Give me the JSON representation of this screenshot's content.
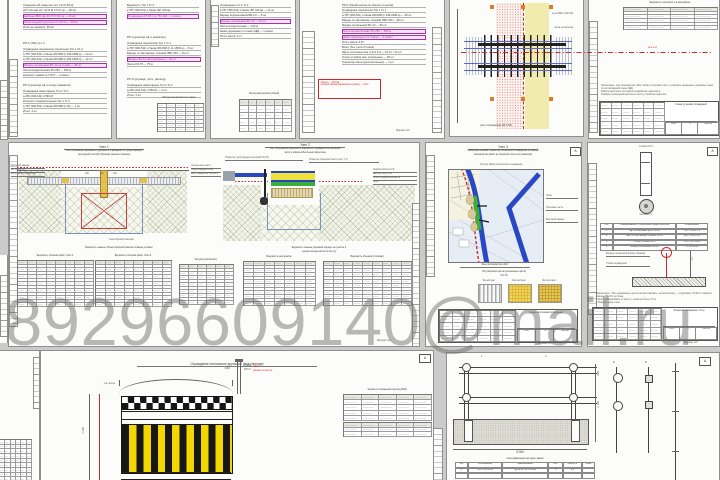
{
  "watermark": "89296609140@mail.ru",
  "colors": {
    "canvas": "#cbcbcb",
    "sheet": "#fcfcfa",
    "red": "#cc2a2a",
    "magenta": "#a832a8",
    "blue": "#2a48c4",
    "green": "#3cae3c",
    "stripe_yellow": "#f2d800",
    "pale_yellow": "#f1ecae",
    "orange": "#e07b28"
  },
  "stamp": {
    "sheet_label": "Лист",
    "sheets_label": "Листов"
  },
  "top": {
    "s1": {
      "b1": [
        {
          "t": "Уширение а/б покрытия тип 1 (h=0,56 м)"
        },
        {
          "t": "а/б плотный м/з тип Б М II h=5 см — 96 м2"
        },
        {
          "t": "Щебень М800 фр.40-70 h=30 см — 29 м3",
          "hl": true
        },
        {
          "t": "Песок средней крупности h=20 см — 19 м3",
          "hl": true
        },
        {
          "t": "Итого на захватку: 96 м2"
        }
      ],
      "h1": "РР-1 (УШ-1) п.1",
      "b2": [
        {
          "t": "Ограждение переносное сигнальное Тип 1 С1-3"
        },
        {
          "t": "а-787 (306-541) и башм.180-808 (п.349-1808-а) — 24 шт"
        },
        {
          "t": "а-787 (306-541) и башм.180-808 (п.363-1818-б) — 12 шт"
        },
        {
          "t": "Фонарь сигнальный ФС-12 на стойке — 36 шт",
          "hl": true
        },
        {
          "t": "Лента оградительная ЛО-250 — 250 м"
        },
        {
          "t": "Комплект знаков по ГОСТ — 2 компл"
        }
      ],
      "h2": "РР-2 (расход на 1 опору захватки)",
      "b3": [
        {
          "t": "Ограждение инвентарное Тип 2 Тс-1"
        },
        {
          "t": "а-250 (248-441) и 560-М"
        },
        {
          "t": "Комплект соединительный Тип 1 Тс-У"
        },
        {
          "t": "а-787 (306-541) и башм.180-808 (п.16) — 4 шт"
        },
        {
          "t": "Итого: 4 шт"
        }
      ]
    },
    "s2": {
      "b1": [
        {
          "t": "Ведомость Тип 1 Тс 3"
        },
        {
          "t": "в 787 (306-541) и башм.-БР 340 вв"
        },
        {
          "t": "Ограждение 97-ЛК 2 м; ПС-340 — 1 компл",
          "hl": true
        }
      ],
      "h1": "РР-4 (расход на 1 захватку)",
      "b2": [
        {
          "t": "Ограждение переносное Тип 1 Тс 1"
        },
        {
          "t": "а-787 (306-541) и башм.180-808 (п.11-1808-а) — 8 шт"
        },
        {
          "t": "Барьер со световозвр. пленкой ЛВО 250 — 16 шт"
        },
        {
          "t": "Фонарь ФС-12 светодиодный — 16 шт",
          "hl": true
        },
        {
          "t": "Лента ЛО-75 — 75 м"
        }
      ],
      "h2": "РР-5 (огражд. пути, расход)",
      "b3": [
        {
          "t": "Ограждение инвентарное Тип 2 Тс 2"
        },
        {
          "t": "а-250 (244-141) и 560-М — 2 шт"
        },
        {
          "t": "Итого: 2 шт"
        }
      ],
      "tcap": "Расход материалов на 1 звено"
    },
    "s3": {
      "b1": [
        {
          "t": "Ограждение тип 1 Тс 2"
        },
        {
          "t": "в 787 (306-541) и башм.-БР 340 вв — 12 шт"
        },
        {
          "t": "Барьер водоналивной БВ-2,0 — 8 шт"
        },
        {
          "t": "Фонарь сигнальный ФС-12 — 24 шт",
          "hl": true
        },
        {
          "t": "Лента оградительная — 120 м"
        },
        {
          "t": "Знаки дорожные по схеме ОДД — 1 компл"
        },
        {
          "t": "Итого масса: 2,4 т"
        }
      ],
      "scap": "Расход материалов (общий)"
    },
    "s4": {
      "b1": [
        {
          "t": "РР-6 (общий расход по объекту в целом)"
        },
        {
          "t": "Ограждение переносное Тип 1 Тс 1"
        },
        {
          "t": "а-787 (306-541) и башм.180-808 (п.349-1808-а) — 48 шт"
        },
        {
          "t": "Барьер со световозвр. пленкой ЛВО 250 — 96 шт"
        },
        {
          "t": "Фонарь сигнальный ФС-12 — 96 шт"
        },
        {
          "t": "Лента оградительная ЛО-250 — 500 м",
          "hl": true
        },
        {
          "t": "Знаки дорожные (I-IV этапы) — 1 компл",
          "hl": true
        },
        {
          "t": "Итого масса: 4,8 т"
        }
      ],
      "b2": [
        {
          "t": "Всего (без учета III этапа):"
        },
        {
          "t": "Щиты сплошные инв. 2,0х1,6 м — 24 шт / 12 шт"
        },
        {
          "t": "Опоры (стойки) инв. сигнальные — 48 шт"
        },
        {
          "t": "Генератор света (дополнительно) — 1 шт"
        }
      ],
      "note": [
        "1 Всего — 547 м2",
        "2 Длина забора (временное огражд.) — 62 м"
      ],
      "fmt": "Формат А3"
    },
    "s5": {
      "lbl1": "сетка 5Вр1 100х100",
      "lbl2": "лента сигнальная",
      "cap": "узел сопряжения (М 1:50)",
      "axis": "ось 2-2"
    },
    "s6": {
      "tcap": "Ведомость потребности в материалах",
      "par": [
        "Примечание: при производстве работ вблизи проезжей части установить временные дорожные знаки по согласованной схеме ОДД.",
        "Работы выполнять при закрытом движении транспорта.",
        "Разборку ограждения выполнять после устройства покрытия."
      ],
      "st": {
        "name": "Схема установки ограждений",
        "num": "3"
      },
      "fmt": "Формат А3"
    }
  },
  "mid": {
    "m1": {
      "u1t1": "Узел 1",
      "u1t2": "Узел сопряжения временного дорожного ограждения со существующей",
      "u1t3": "тротуарной плиткой (обратная засыпка траншеи)",
      "u1ll": [
        "Бортовой камень",
        "БР 100.30.15",
        "Восстановл. покрытия"
      ],
      "u1lr": [
        "Сигнальная лента",
        "Подстилающий слой",
        "Борт. камень БР 100.20.8"
      ],
      "u1dims": [
        "150",
        "60",
        "150"
      ],
      "u1x": "зона обратной засыпки",
      "u1cap": "Ведомость замены (объем обратной засыпки показан условно)",
      "u2t1": "Узел 2",
      "u2t2": "Узел сопряжения временного дорожного ограждения на проезжей",
      "u2t3": "части с асфальтобетонным покрытием",
      "u2ul1": "Покрытие (тротуарная плитка) ЕР 30,9 Б",
      "u2ul2": "Покрытие проезжей части (лист 7.1)",
      "u2lr": [
        "Асфальтобетон h=5",
        "Щебень фр.20-40",
        "Песок средней крупности",
        "Грунт"
      ],
      "u2cap1": "Ведомость замены дорожной одежды на участке 2",
      "u2cap2": "(длина определяется по месту)",
      "tcaps": [
        "Ведомость объемов работ. Этап 1",
        "Ведомость объемов работ. Этап 2",
        "Ресурсы (вспомогат.)",
        "Ведомость материалов",
        "Ведомость объемов (итоговая)"
      ],
      "fmt": "Формат А3"
    },
    "m2": {
      "t1": "Узел 3",
      "t2": "Схема расстановки элементов сигнального ограждения и границы",
      "t3": "производства работ на проезжей части (по захваткам)",
      "mtop": "Тротуар      Линия сигнального ограждения",
      "mlr": [
        "Газон",
        "Проезжая часть",
        "Бортовой камень"
      ],
      "mapcap": "Зона производства работ",
      "swcap1": "Тип раскраски щитов (сигнальные цвета)",
      "swcap2": "М 1:20",
      "swl": [
        "Белый цвет",
        "Желтый цвет",
        "Желтый цвет"
      ],
      "st": {
        "name": "Схема расстановки ограждения",
        "num": "4"
      },
      "corner": "А",
      "fmt": "Формат А3"
    },
    "m3": {
      "postcap": "Стойка СО-1",
      "circcap": "Сечение 1-1",
      "tcols": [
        "Поз.",
        "Наименование и техническая характеристика",
        "Обозначение"
      ],
      "rows": [
        [
          "1",
          "Щит сигнальный ЩС 2,0х1,6",
          "ГОСТ 23407-78"
        ],
        [
          "2",
          "Щит со световозвр. пленкой тип А",
          "сер. 3.503.1-66"
        ],
        [
          "3",
          "Опора (стойка) СО-1",
          "ГОСТ 10704-91"
        ],
        [
          "4",
          "Фонарь сигнальный ФС-12",
          "ТУ 3461-001"
        ]
      ],
      "hookl1": "Фонарь сигнальный (опорн. башмак)",
      "hookl2": "Стойка ограждения",
      "hookdim": "750",
      "note": [
        "Примечание: 1 Все деревянные детали антисептировать, металлические — огрунтовать ГФ-021 и окрасить эмалью ПФ-115 за 2 раза.",
        "2 Щиты устанавливать по месту с шагом не более 1,5 м.",
        "3 Размеры даны в мм."
      ],
      "st": {
        "name": "Элементы ограждения. Узлы",
        "num": "5"
      },
      "corner": "А",
      "fmt": "Формат А3"
    }
  },
  "bot": {
    "f": {
      "t1": "Ограждение сигнальное дорожное (вид спереди)",
      "t2": "1:20",
      "red1": "навес",
      "red2": "(размер по месту)",
      "lbl1": "отм. верха",
      "lbl2": "+1,200",
      "rot": "1 200",
      "post1": "стойка",
      "post2": "Ф57х3",
      "tcap": "Элементы ограждения (расход ЛКМ)",
      "corner": "А"
    },
    "g": {
      "corner": "А",
      "flag1": "1",
      "flag2": "2",
      "dimw": "3 000",
      "dimh1": "800",
      "dimh2": "1 100",
      "d1": "Б",
      "d2": "В",
      "speccap": "Спецификация на одно звено",
      "speccols": [
        "Поз.",
        "Обозначение",
        "Наименование",
        "Кол.",
        "Масса, кг",
        "Прим."
      ],
      "specrow": [
        "1",
        "ГОСТ 10704-91",
        "Труба Ф57х3, L=2200",
        "2",
        "8,9",
        ""
      ]
    }
  }
}
